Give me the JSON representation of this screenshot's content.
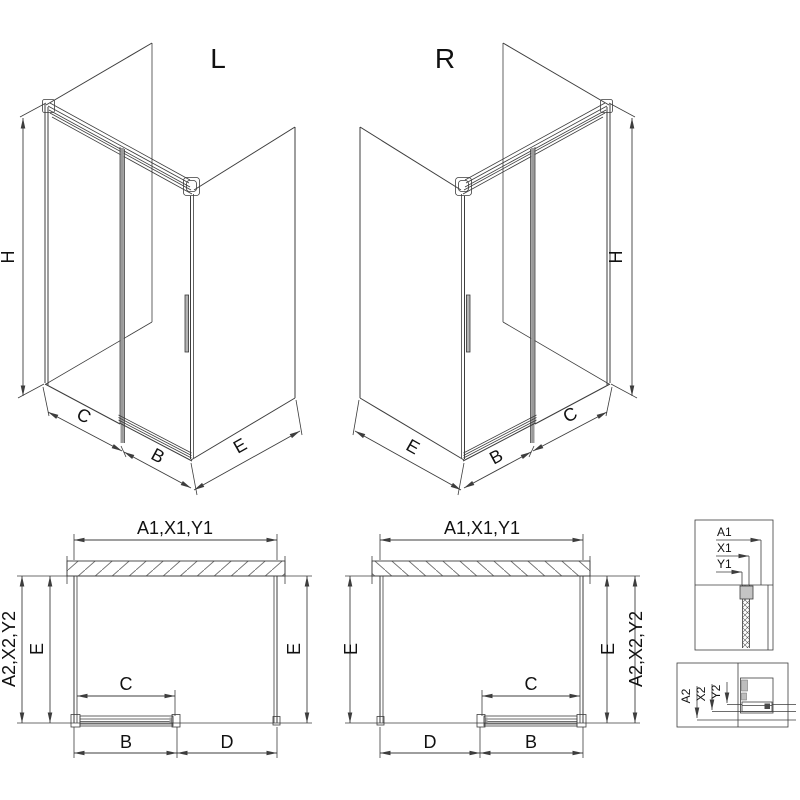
{
  "drawing": {
    "iso_left": {
      "title": "L",
      "height": "H",
      "seg_fixed": "C",
      "seg_door": "B",
      "seg_side": "E"
    },
    "iso_right": {
      "title": "R",
      "height": "H",
      "seg_fixed": "C",
      "seg_door": "B",
      "seg_side": "E"
    },
    "plan_left": {
      "width_top": "A1,X1,Y1",
      "depth_side": "A2,X2,Y2",
      "depth_left": "E",
      "depth_right": "E",
      "opening": "C",
      "door": "B",
      "fixed": "D"
    },
    "plan_right": {
      "width_top": "A1,X1,Y1",
      "depth_side": "A2,X2,Y2",
      "depth_left": "E",
      "depth_right": "E",
      "opening": "C",
      "door": "B",
      "fixed": "D"
    },
    "detail_top": {
      "labels": [
        "A1",
        "X1",
        "Y1"
      ]
    },
    "detail_bottom": {
      "labels": [
        "A2",
        "X2",
        "Y2"
      ]
    }
  },
  "colors": {
    "line": "#3d3d3d",
    "door_grey": "#9a9a9a",
    "hatch": "#6f6f6f",
    "cap_grey": "#c4c4c4",
    "text": "#111111",
    "background": "#ffffff"
  }
}
